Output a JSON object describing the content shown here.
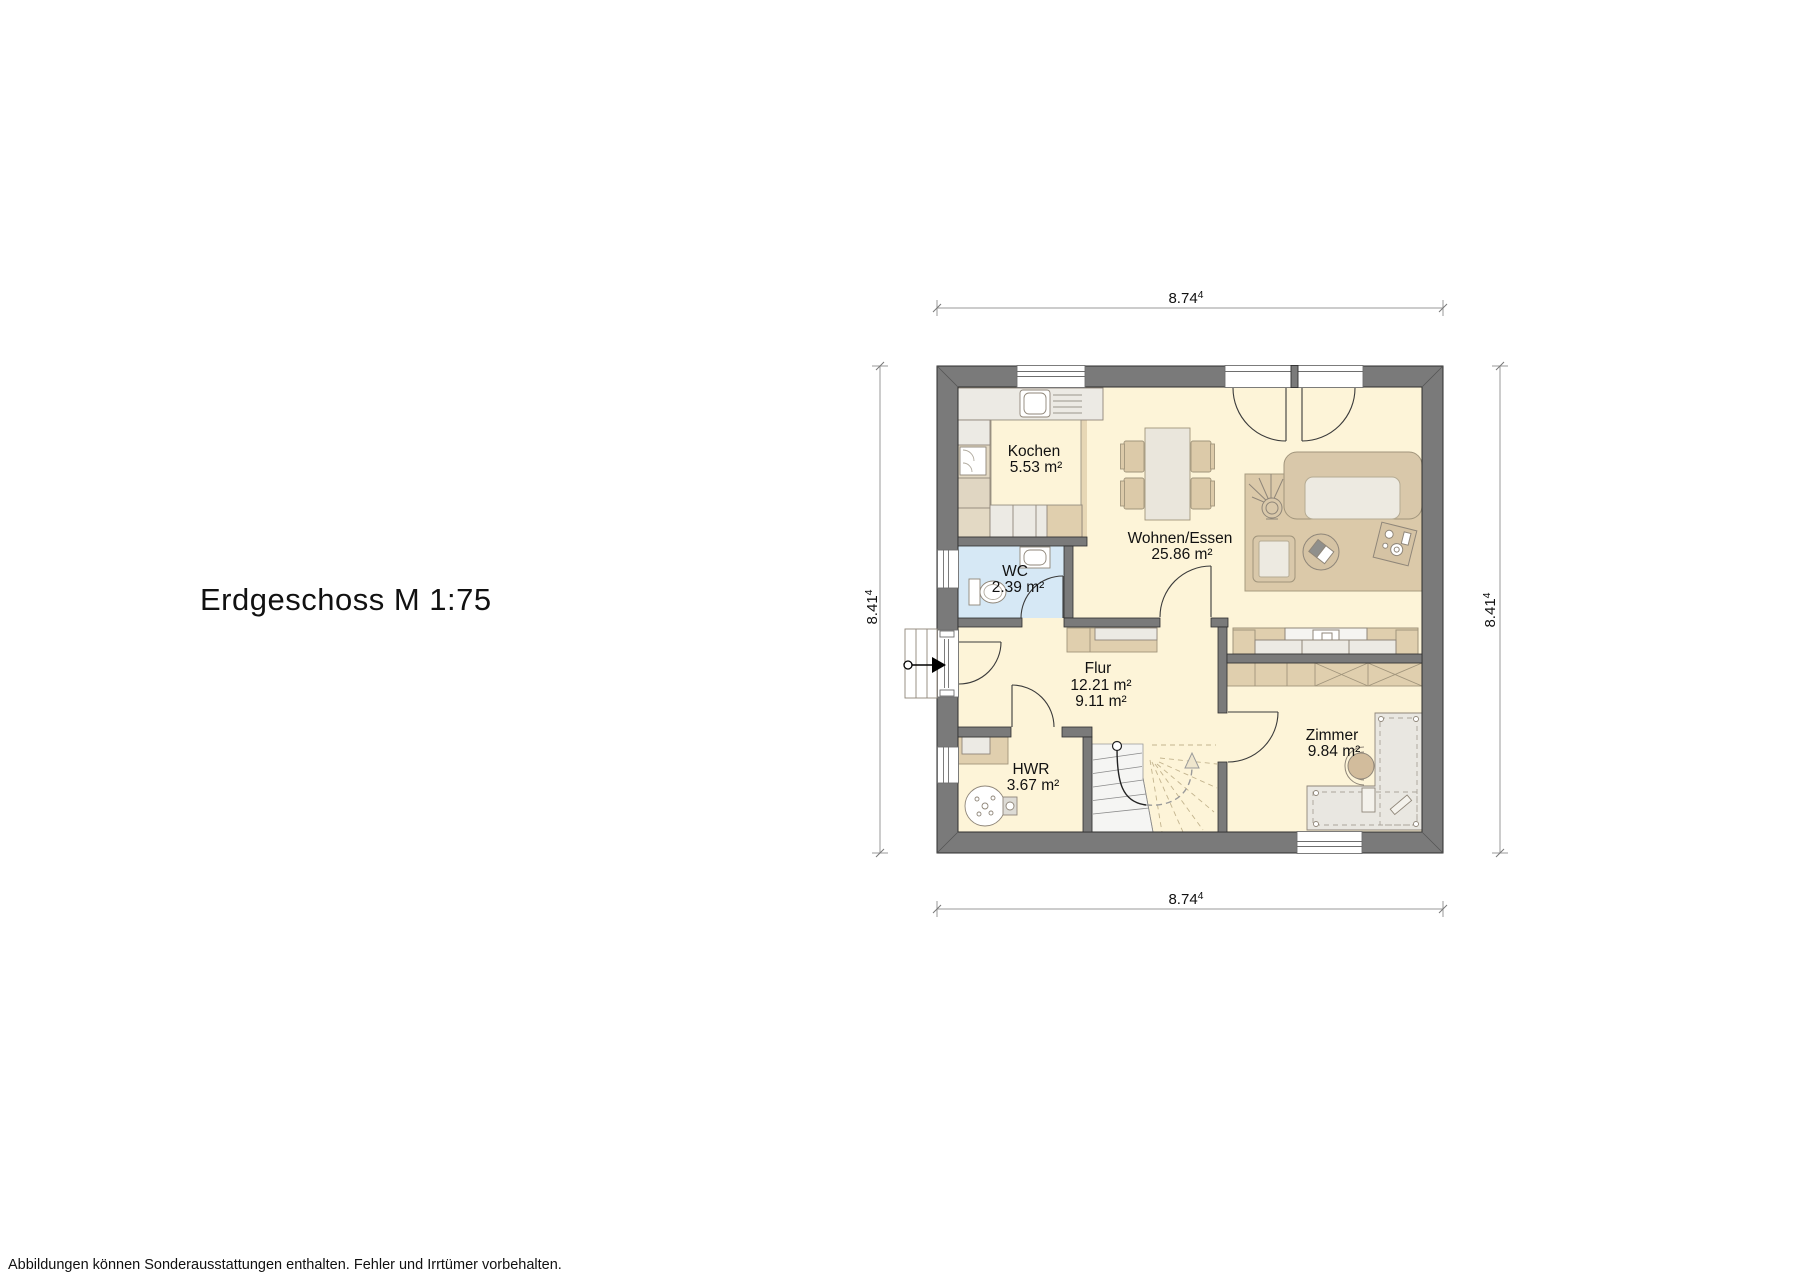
{
  "title": "Erdgeschoss M 1:75",
  "footer": "Abbildungen können Sonderausstattungen enthalten. Fehler und Irrtümer vorbehalten.",
  "dimensions": {
    "top": {
      "value": "8.74",
      "sup": "4"
    },
    "bottom": {
      "value": "8.74",
      "sup": "4"
    },
    "left": {
      "value": "8.41",
      "sup": "4"
    },
    "right": {
      "value": "8.41",
      "sup": "4"
    }
  },
  "rooms": {
    "kochen": {
      "name": "Kochen",
      "area": "5.53 m²"
    },
    "wohnen_essen": {
      "name": "Wohnen/Essen",
      "area": "25.86 m²"
    },
    "wc": {
      "name": "WC",
      "area": "2.39 m²"
    },
    "flur": {
      "name": "Flur",
      "area1": "12.21 m²",
      "area2": "9.11 m²"
    },
    "hwr": {
      "name": "HWR",
      "area": "3.67 m²"
    },
    "zimmer": {
      "name": "Zimmer",
      "area": "9.84 m²"
    }
  },
  "colors": {
    "wall": "#7a7a7a",
    "floor": "#fdf4d8",
    "kitchen_floor": "#e7d7b5",
    "wc_floor": "#d6e8f5",
    "furniture_tan": "#dccaa9",
    "rug": "#dbc9a9",
    "outline": "#8f8679",
    "dimension_line": "#9a9a9a"
  }
}
